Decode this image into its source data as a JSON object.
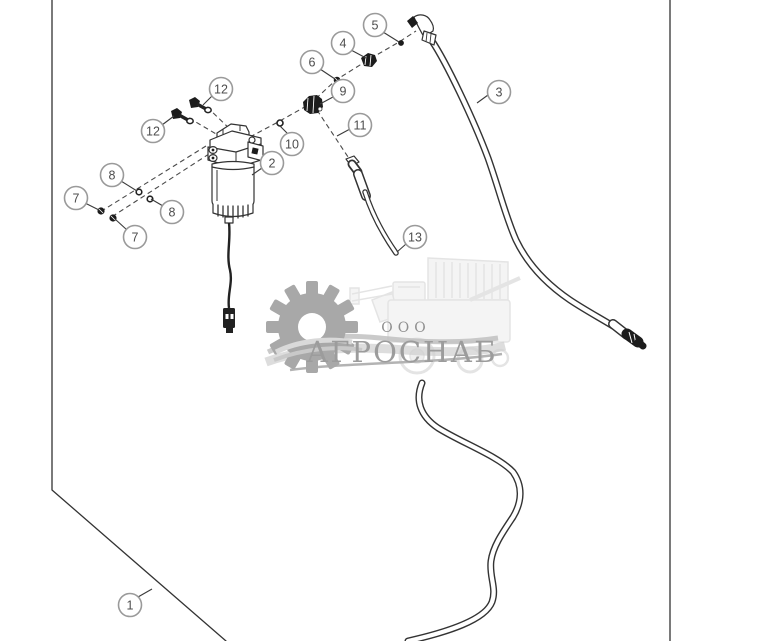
{
  "diagram": {
    "type": "exploded-parts-diagram",
    "subject": "fuel filter and hose assembly",
    "callout_numbers_shown": [
      "1",
      "2",
      "3",
      "4",
      "5",
      "6",
      "7",
      "8",
      "9",
      "10",
      "11",
      "12",
      "13"
    ]
  },
  "callouts": {
    "c1": "1",
    "c2": "2",
    "c3": "3",
    "c4": "4",
    "c5": "5",
    "c6": "6",
    "c7a": "7",
    "c7b": "7",
    "c8a": "8",
    "c8b": "8",
    "c9": "9",
    "c10": "10",
    "c11": "11",
    "c12a": "12",
    "c12b": "12",
    "c13": "13"
  },
  "watermark": {
    "org_form": "ООО",
    "name": "АГРОСНАБ"
  },
  "colors": {
    "background": "#ffffff",
    "line_art": "#333333",
    "dashed_line": "#4a4a4a",
    "callout_circle_stroke": "#9a9a9a",
    "callout_text": "#4d4d4d",
    "watermark_gear": "#a8a8a8",
    "watermark_text": "#9c9c9c",
    "watermark_machine": "#e5e5e5"
  }
}
